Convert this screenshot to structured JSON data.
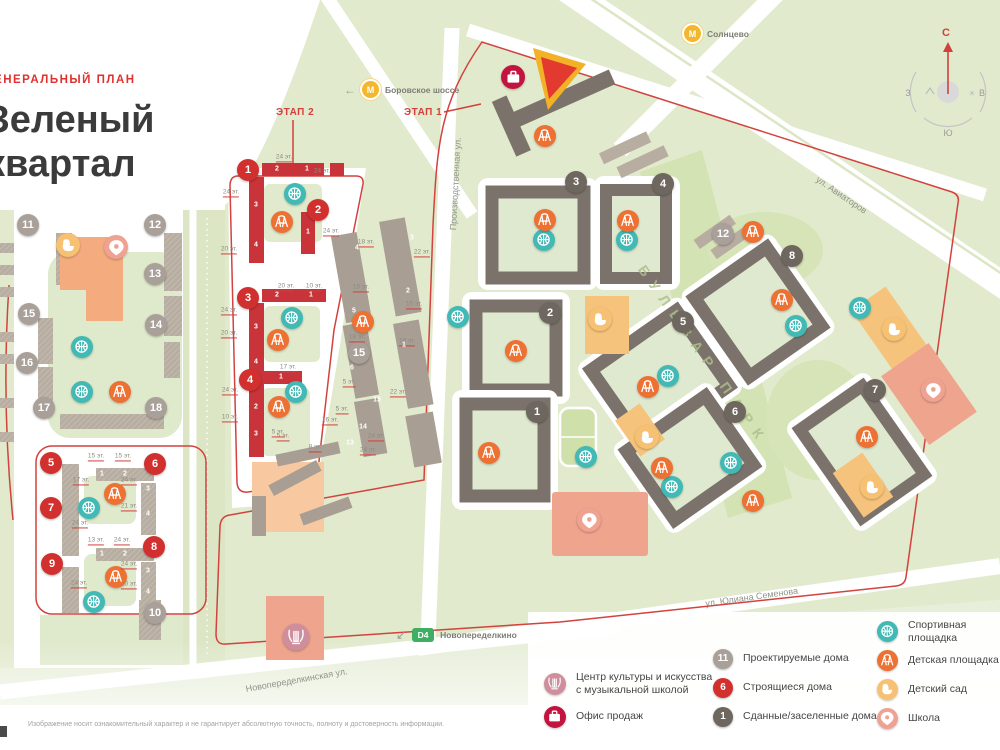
{
  "header": {
    "plan_label": "ГЕНЕРАЛЬНЫЙ ПЛАН",
    "title_line1": "Зеленый",
    "title_line2": "квартал"
  },
  "stages": {
    "stage1": "ЭТАП 1",
    "stage2": "ЭТАП 2"
  },
  "transit": {
    "metro_letter": "М",
    "metro_borovskoe": "Боровское шоссе",
    "metro_solntsevo": "Солнцево",
    "d4_badge": "D4",
    "d4_label": "Новопеределкино",
    "arrow_left": "←",
    "arrow_downleft": "↙"
  },
  "compass": {
    "north": "С",
    "south": "Ю",
    "west": "З",
    "east": "В"
  },
  "streets": {
    "proizvodstvennaya": "Производственная ул.",
    "aviatorov": "ул. Авиаторов",
    "yuliana_semenova": "ул. Юлиана Семенова",
    "novoperedelkinskaya": "Новопеределкинская ул."
  },
  "park_label": "БУЛЬВАР ПАРК",
  "legend": {
    "col1": [
      {
        "icon": "culture",
        "label": "Центр культуры и искусства\nс музыкальной школой"
      },
      {
        "icon": "office",
        "label": "Офис продаж"
      }
    ],
    "col2": [
      {
        "badge": "11",
        "kind": "gray",
        "label": "Проектируемые дома"
      },
      {
        "badge": "6",
        "kind": "red",
        "label": "Строящиеся дома"
      },
      {
        "badge": "1",
        "kind": "dark",
        "label": "Сданные/заселенные дома"
      }
    ],
    "col3": [
      {
        "icon": "sport",
        "label": "Спортивная площадка"
      },
      {
        "icon": "play",
        "label": "Детская площадка"
      },
      {
        "icon": "kinder",
        "label": "Детский сад"
      },
      {
        "icon": "school",
        "label": "Школа"
      }
    ]
  },
  "disclaimer": "Изображение носит ознакомительный характер и не гарантирует абсолютную точность, полноту и достоверность информации.",
  "colors": {
    "accent_red": "#d2403c",
    "building_built": "#7b736b",
    "building_under_construction": "#c9343a",
    "building_projected": "#b7ada1",
    "sport": "#41b9b4",
    "playground": "#ed7133",
    "kindergarten": "#f6c172",
    "school": "#efa291",
    "culture": "#cf8e9c",
    "office": "#c2143f",
    "metro": "#f3b62c",
    "d4": "#3fae62",
    "map_green": "#e1eacd"
  },
  "map": {
    "badges": [
      {
        "n": "11",
        "k": "gray",
        "x": 28,
        "y": 225
      },
      {
        "n": "12",
        "k": "gray",
        "x": 155,
        "y": 225
      },
      {
        "n": "13",
        "k": "gray",
        "x": 155,
        "y": 274
      },
      {
        "n": "14",
        "k": "gray",
        "x": 156,
        "y": 325
      },
      {
        "n": "15",
        "k": "gray",
        "x": 29,
        "y": 314
      },
      {
        "n": "16",
        "k": "gray",
        "x": 27,
        "y": 363
      },
      {
        "n": "17",
        "k": "gray",
        "x": 44,
        "y": 408
      },
      {
        "n": "18",
        "k": "gray",
        "x": 156,
        "y": 408
      },
      {
        "n": "10",
        "k": "gray",
        "x": 155,
        "y": 613
      },
      {
        "n": "15",
        "k": "gray",
        "x": 359,
        "y": 353
      },
      {
        "n": "12",
        "k": "gray",
        "x": 723,
        "y": 234
      },
      {
        "n": "1",
        "k": "red",
        "x": 248,
        "y": 170
      },
      {
        "n": "2",
        "k": "red",
        "x": 318,
        "y": 210
      },
      {
        "n": "3",
        "k": "red",
        "x": 248,
        "y": 298
      },
      {
        "n": "4",
        "k": "red",
        "x": 250,
        "y": 380
      },
      {
        "n": "5",
        "k": "red",
        "x": 51,
        "y": 463
      },
      {
        "n": "6",
        "k": "red",
        "x": 155,
        "y": 464
      },
      {
        "n": "7",
        "k": "red",
        "x": 51,
        "y": 508
      },
      {
        "n": "8",
        "k": "red",
        "x": 154,
        "y": 547
      },
      {
        "n": "9",
        "k": "red",
        "x": 52,
        "y": 564
      },
      {
        "n": "1",
        "k": "dark",
        "x": 537,
        "y": 412
      },
      {
        "n": "2",
        "k": "dark",
        "x": 550,
        "y": 313
      },
      {
        "n": "3",
        "k": "dark",
        "x": 576,
        "y": 182
      },
      {
        "n": "4",
        "k": "dark",
        "x": 663,
        "y": 184
      },
      {
        "n": "5",
        "k": "dark",
        "x": 683,
        "y": 322
      },
      {
        "n": "6",
        "k": "dark",
        "x": 735,
        "y": 412
      },
      {
        "n": "7",
        "k": "dark",
        "x": 875,
        "y": 390
      },
      {
        "n": "8",
        "k": "dark",
        "x": 792,
        "y": 256
      }
    ],
    "icons": [
      {
        "t": "sport",
        "x": 82,
        "y": 347
      },
      {
        "t": "sport",
        "x": 82,
        "y": 392
      },
      {
        "t": "sport",
        "x": 89,
        "y": 508
      },
      {
        "t": "sport",
        "x": 94,
        "y": 602
      },
      {
        "t": "sport",
        "x": 295,
        "y": 194
      },
      {
        "t": "sport",
        "x": 292,
        "y": 318
      },
      {
        "t": "sport",
        "x": 296,
        "y": 392
      },
      {
        "t": "sport",
        "x": 458,
        "y": 317
      },
      {
        "t": "sport",
        "x": 544,
        "y": 240
      },
      {
        "t": "sport",
        "x": 586,
        "y": 457
      },
      {
        "t": "sport",
        "x": 627,
        "y": 240
      },
      {
        "t": "sport",
        "x": 668,
        "y": 376
      },
      {
        "t": "sport",
        "x": 672,
        "y": 487
      },
      {
        "t": "sport",
        "x": 731,
        "y": 463
      },
      {
        "t": "sport",
        "x": 796,
        "y": 326
      },
      {
        "t": "sport",
        "x": 860,
        "y": 308
      },
      {
        "t": "play",
        "x": 120,
        "y": 392
      },
      {
        "t": "play",
        "x": 115,
        "y": 494
      },
      {
        "t": "play",
        "x": 116,
        "y": 577
      },
      {
        "t": "play",
        "x": 282,
        "y": 222
      },
      {
        "t": "play",
        "x": 278,
        "y": 340
      },
      {
        "t": "play",
        "x": 279,
        "y": 407
      },
      {
        "t": "play",
        "x": 363,
        "y": 322
      },
      {
        "t": "play",
        "x": 489,
        "y": 453
      },
      {
        "t": "play",
        "x": 516,
        "y": 351
      },
      {
        "t": "play",
        "x": 545,
        "y": 136
      },
      {
        "t": "play",
        "x": 545,
        "y": 220
      },
      {
        "t": "play",
        "x": 628,
        "y": 221
      },
      {
        "t": "play",
        "x": 648,
        "y": 387
      },
      {
        "t": "play",
        "x": 662,
        "y": 468
      },
      {
        "t": "play",
        "x": 753,
        "y": 232
      },
      {
        "t": "play",
        "x": 753,
        "y": 501
      },
      {
        "t": "play",
        "x": 782,
        "y": 300
      },
      {
        "t": "play",
        "x": 867,
        "y": 437
      },
      {
        "t": "kinder",
        "x": 68,
        "y": 245
      },
      {
        "t": "kinder",
        "x": 600,
        "y": 319
      },
      {
        "t": "kinder",
        "x": 647,
        "y": 437
      },
      {
        "t": "kinder",
        "x": 872,
        "y": 487
      },
      {
        "t": "kinder",
        "x": 894,
        "y": 329
      },
      {
        "t": "school",
        "x": 116,
        "y": 247
      },
      {
        "t": "school",
        "x": 589,
        "y": 520
      },
      {
        "t": "school",
        "x": 933,
        "y": 390
      },
      {
        "t": "culture",
        "x": 296,
        "y": 637
      },
      {
        "t": "office",
        "x": 513,
        "y": 77
      }
    ],
    "floors": [
      {
        "t": "24 эт.",
        "x": 284,
        "y": 158
      },
      {
        "t": "24 эт.",
        "x": 322,
        "y": 172
      },
      {
        "t": "24 эт.",
        "x": 231,
        "y": 193
      },
      {
        "t": "20 эт.",
        "x": 229,
        "y": 250
      },
      {
        "t": "24 эт.",
        "x": 331,
        "y": 232
      },
      {
        "t": "20 эт.",
        "x": 286,
        "y": 287
      },
      {
        "t": "10 эт.",
        "x": 314,
        "y": 287
      },
      {
        "t": "24 эт.",
        "x": 229,
        "y": 311
      },
      {
        "t": "20 эт.",
        "x": 229,
        "y": 334
      },
      {
        "t": "17 эт.",
        "x": 288,
        "y": 368
      },
      {
        "t": "24 эт.",
        "x": 230,
        "y": 391
      },
      {
        "t": "10 эт.",
        "x": 230,
        "y": 418
      },
      {
        "t": "5 эт.",
        "x": 283,
        "y": 437
      },
      {
        "t": "15 эт.",
        "x": 96,
        "y": 457
      },
      {
        "t": "15 эт.",
        "x": 123,
        "y": 457
      },
      {
        "t": "17 эт.",
        "x": 81,
        "y": 481
      },
      {
        "t": "24 эт.",
        "x": 129,
        "y": 481
      },
      {
        "t": "21 эт.",
        "x": 129,
        "y": 507
      },
      {
        "t": "24 эт.",
        "x": 80,
        "y": 524
      },
      {
        "t": "13 эт.",
        "x": 96,
        "y": 541
      },
      {
        "t": "24 эт.",
        "x": 122,
        "y": 541
      },
      {
        "t": "24 эт.",
        "x": 129,
        "y": 565
      },
      {
        "t": "24 эт.",
        "x": 79,
        "y": 584
      },
      {
        "t": "20 эт.",
        "x": 129,
        "y": 585
      },
      {
        "t": "18 эт.",
        "x": 366,
        "y": 243
      },
      {
        "t": "22 эт.",
        "x": 422,
        "y": 253
      },
      {
        "t": "15 эт.",
        "x": 361,
        "y": 288
      },
      {
        "t": "15 эт.",
        "x": 414,
        "y": 305
      },
      {
        "t": "18 эт.",
        "x": 357,
        "y": 338
      },
      {
        "t": "18 эт.",
        "x": 407,
        "y": 342
      },
      {
        "t": "5 эт.",
        "x": 349,
        "y": 383
      },
      {
        "t": "22 эт.",
        "x": 398,
        "y": 393
      },
      {
        "t": "5 эт.",
        "x": 342,
        "y": 410
      },
      {
        "t": "16 эт.",
        "x": 330,
        "y": 421
      },
      {
        "t": "24 эт.",
        "x": 376,
        "y": 437
      },
      {
        "t": "8 эт.",
        "x": 315,
        "y": 448
      },
      {
        "t": "5 эт.",
        "x": 278,
        "y": 433
      },
      {
        "t": "24 эт.",
        "x": 368,
        "y": 451
      }
    ],
    "corps": [
      {
        "t": "2",
        "x": 277,
        "y": 169
      },
      {
        "t": "1",
        "x": 307,
        "y": 169
      },
      {
        "t": "3",
        "x": 256,
        "y": 205
      },
      {
        "t": "4",
        "x": 256,
        "y": 245
      },
      {
        "t": "1",
        "x": 308,
        "y": 232
      },
      {
        "t": "2",
        "x": 277,
        "y": 295
      },
      {
        "t": "1",
        "x": 311,
        "y": 295
      },
      {
        "t": "3",
        "x": 256,
        "y": 327
      },
      {
        "t": "4",
        "x": 256,
        "y": 362
      },
      {
        "t": "1",
        "x": 281,
        "y": 377
      },
      {
        "t": "2",
        "x": 256,
        "y": 407
      },
      {
        "t": "3",
        "x": 256,
        "y": 434
      },
      {
        "t": "4",
        "x": 357,
        "y": 248
      },
      {
        "t": "5",
        "x": 354,
        "y": 311
      },
      {
        "t": "6",
        "x": 352,
        "y": 368
      },
      {
        "t": "3",
        "x": 412,
        "y": 238
      },
      {
        "t": "2",
        "x": 408,
        "y": 291
      },
      {
        "t": "1",
        "x": 404,
        "y": 345
      },
      {
        "t": "1",
        "x": 59,
        "y": 481
      },
      {
        "t": "1",
        "x": 102,
        "y": 474
      },
      {
        "t": "2",
        "x": 125,
        "y": 474
      },
      {
        "t": "3",
        "x": 148,
        "y": 489
      },
      {
        "t": "4",
        "x": 148,
        "y": 514
      },
      {
        "t": "1",
        "x": 59,
        "y": 527
      },
      {
        "t": "1",
        "x": 102,
        "y": 554
      },
      {
        "t": "2",
        "x": 125,
        "y": 554
      },
      {
        "t": "3",
        "x": 148,
        "y": 571
      },
      {
        "t": "4",
        "x": 148,
        "y": 592
      },
      {
        "t": "1",
        "x": 59,
        "y": 588
      },
      {
        "t": "15",
        "x": 377,
        "y": 400
      },
      {
        "t": "14",
        "x": 363,
        "y": 427
      },
      {
        "t": "13",
        "x": 350,
        "y": 443
      }
    ]
  }
}
